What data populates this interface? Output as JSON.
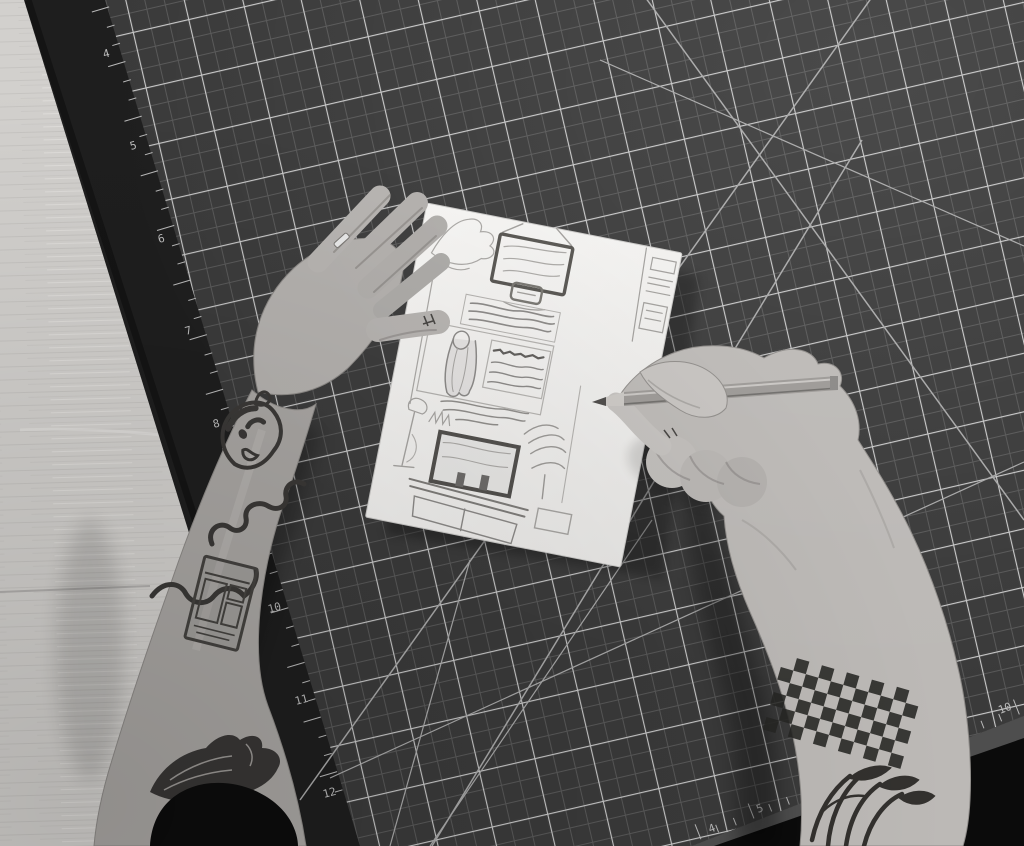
{
  "scene": {
    "type": "black-and-white overhead photograph",
    "description": "Two tattooed arms over a dark self-healing cutting mat on a light wooden table. The left hand holds a white sheet bearing a pencil storyboard sketch while the right hand draws on it with a gray pencil.",
    "lighting": "soft daylight from upper right"
  },
  "palette": {
    "wood": "#d2d0cd",
    "wood_grain": "#c6c4c1",
    "mat_field": "#3e3e3e",
    "mat_cell": "#3a3a3a",
    "mat_line_major": "#c9c9c9",
    "mat_line_minor": "#585858",
    "mat_border": "#1e1e1e",
    "mat_edge_face": "#4e4e4e",
    "off_mat_dark": "#0b0b0b",
    "paper": "#f4f3f1",
    "sketch_light": "#a09e9b",
    "sketch_mid": "#8a8886",
    "sketch_dark": "#55534f",
    "skin_left": "#aeaba8",
    "skin_right": "#bcb9b6",
    "skin_shadow": "#7d7a77",
    "tattoo_ink": "#33312e",
    "pencil_body": "#9c9996",
    "pencil_highlight": "#c9c6c3",
    "pencil_graphite": "#4c4a48",
    "sleeve_black": "#0c0c0c",
    "ring_silver": "#e8e8e8"
  },
  "table": {
    "material": "light wood with fine horizontal grain and one plank seam"
  },
  "cutting_mat": {
    "kind": "self-healing cutting mat, rotated slightly counterclockwise",
    "grid": {
      "major_cell_px": 57,
      "minor_divisions": 3,
      "diagonal_guides": true
    },
    "ruler_numbers_left": [
      "4",
      "5",
      "6",
      "7",
      "8",
      "9",
      "10",
      "11",
      "12"
    ],
    "ruler_numbers_bottom": [
      "4",
      "5",
      "6",
      "7",
      "8",
      "9",
      "10"
    ],
    "ticks_left": {
      "count": 43,
      "step": 19,
      "minor_len": 8,
      "major_len": 18,
      "every": 3,
      "side": 1
    },
    "ticks_bottom": {
      "count": 18,
      "step": 19,
      "minor_len": 8,
      "major_len": 16,
      "every": 3,
      "side": -1
    }
  },
  "paper_sketch": {
    "media": "pencil on white paper, rotated clockwise ~11 degrees",
    "panels": [
      "faint figure in top-left corner",
      "wall-mounted TV with small media box below",
      "narrow annotation column along right edge",
      "paragraph of scribbled handwriting",
      "long-haired figure seen from behind facing a chart board with wavy text",
      "more scribbled caption lines",
      "living room: TV on a media console with two small objects",
      "floor lamp and leafy plants flanking the console"
    ]
  },
  "left_arm": {
    "ring": "thin silver band on finger",
    "clothing": "black rolled-up sleeve at lower edge",
    "tattoos": [
      "cartoon face on wrist",
      "looping squiggle band around forearm",
      "rectangular vending-machine on forearm",
      "large dark bird on upper arm",
      "tiny symbols on thumb"
    ]
  },
  "right_arm": {
    "holding": "gray drawing pencil, tip on paper",
    "tattoos": [
      "pixel checkerboard armband on forearm",
      "leafy botanical piece on upper arm",
      "tiny mark on index finger"
    ],
    "checker_config": {
      "rows": 7,
      "cols": 11,
      "cell": 13
    }
  }
}
